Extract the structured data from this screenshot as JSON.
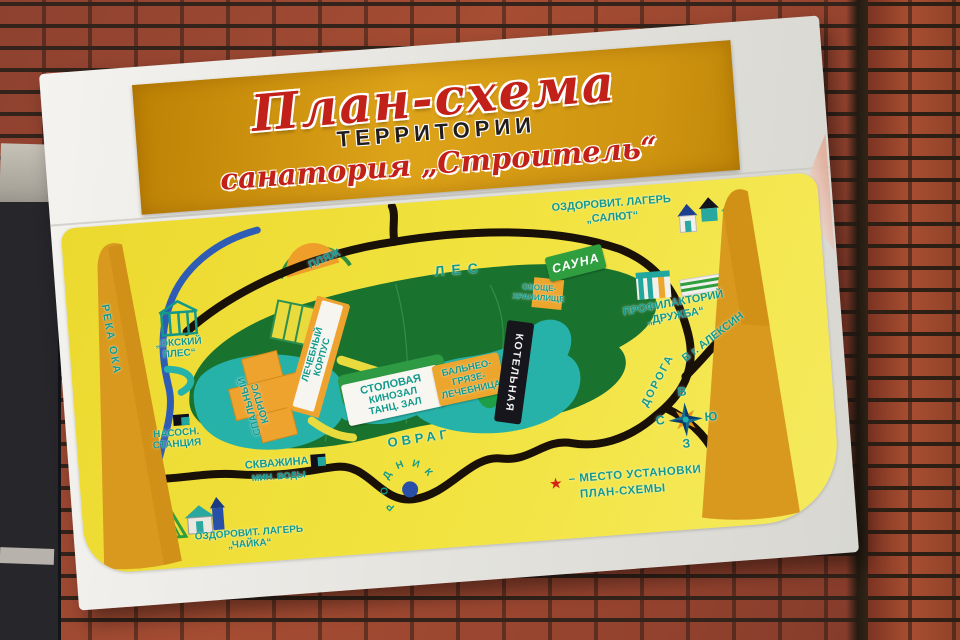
{
  "sign": {
    "title": {
      "line1": "План-схема",
      "line2": "ТЕРРИТОРИИ",
      "line3": "санатория „Строитель“"
    }
  },
  "map": {
    "forest": "ЛЕС",
    "beach": "ПЛЯЖ",
    "river": "РЕКА ОКА",
    "ples": {
      "line1": "„ОКСКИЙ",
      "line2": "ПЛЕС“"
    },
    "pump": {
      "line1": "НАСОСН.",
      "line2": "СТАНЦИЯ"
    },
    "well": {
      "line1": "СКВАЖИНА",
      "line2": "МИН. ВОДЫ"
    },
    "chaika": {
      "line1": "ОЗДОРОВИТ. ЛАГЕРЬ",
      "line2": "„ЧАЙКА“"
    },
    "salut": {
      "line1": "ОЗДОРОВИТ. ЛАГЕРЬ",
      "line2": "„САЛЮТ“"
    },
    "ravine": "ОВРАГ",
    "spring_letters": [
      "Р",
      "О",
      "Д",
      "Н",
      "И",
      "К"
    ],
    "dining": {
      "line1": "СТОЛОВАЯ",
      "line2": "КИНОЗАЛ",
      "line3": "ТАНЦ. ЗАЛ"
    },
    "balneo": {
      "line1": "БАЛЬНЕО-",
      "line2": "ГРЯЗЕ-",
      "line3": "ЛЕЧЕБНИЦА"
    },
    "boiler": "КОТЕЛЬНАЯ",
    "sleeping": {
      "line1": "СПАЛЬНЫЙ",
      "line2": "КОРПУС"
    },
    "medical": {
      "line1": "ЛЕЧЕБНЫЙ",
      "line2": "КОРПУС"
    },
    "sauna": "САУНА",
    "vegetable": {
      "line1": "ОВОЩЕ-",
      "line2": "ХРАНИЛИЩЕ"
    },
    "druzhba": {
      "line1": "ПРОФИЛАКТОРИЙ",
      "line2": "„ДРУЖБА“"
    },
    "road": "ДОРОГА",
    "to_city": "В г. АЛЕКСИН",
    "compass": {
      "top": "В",
      "left": "С",
      "right": "Ю",
      "bottom": "З"
    },
    "legend": {
      "star": "★",
      "line1": "– МЕСТО УСТАНОВКИ",
      "line2": "ПЛАН-СХЕМЫ"
    }
  },
  "colors": {
    "title_red": "#c2211a",
    "banner_gold": "#d79a10",
    "panel_yellow": "#f0df38",
    "label_teal": "#12998a",
    "forest_green": "#19722e",
    "pond_teal": "#27b2a9",
    "road_black": "#191007",
    "building_orange": "#efa32f",
    "post_tan": "#d8991e",
    "river_blue": "#2f5cb5",
    "star_red": "#d42316"
  }
}
